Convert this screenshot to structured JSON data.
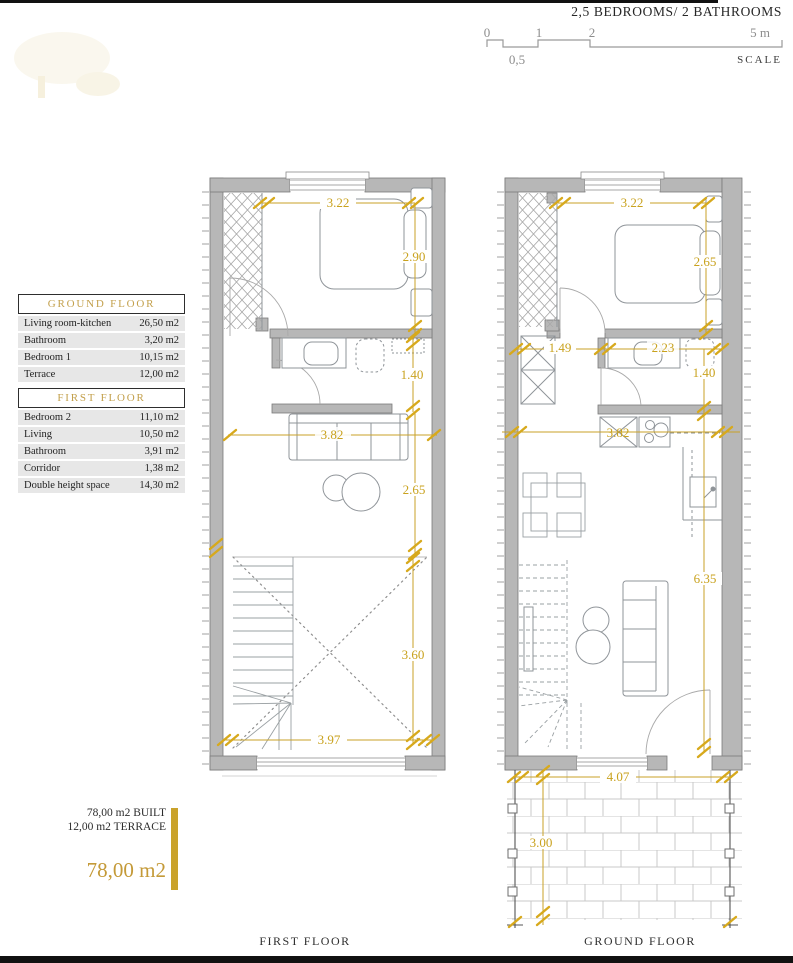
{
  "header": {
    "title": "2,5 BEDROOMS/ 2 BATHROOMS"
  },
  "scale_bar": {
    "t0": "0",
    "t1": "1",
    "t2": "2",
    "t5": "5 m",
    "t05": "0,5",
    "label": "SCALE"
  },
  "tables": {
    "ground": {
      "title": "GROUND FLOOR",
      "rows": [
        {
          "label": "Living room-kitchen",
          "value": "26,50 m2"
        },
        {
          "label": "Bathroom",
          "value": "3,20 m2"
        },
        {
          "label": "Bedroom 1",
          "value": "10,15 m2"
        },
        {
          "label": "Terrace",
          "value": "12,00 m2"
        }
      ]
    },
    "first": {
      "title": "FIRST FLOOR",
      "rows": [
        {
          "label": "Bedroom 2",
          "value": "11,10 m2"
        },
        {
          "label": "Living",
          "value": "10,50 m2"
        },
        {
          "label": "Bathroom",
          "value": "3,91 m2"
        },
        {
          "label": "Corridor",
          "value": "1,38 m2"
        },
        {
          "label": "Double height space",
          "value": "14,30 m2"
        }
      ]
    }
  },
  "summary": {
    "line1": "78,00 m2 BUILT",
    "line2": "12,00 m2 TERRACE",
    "total": "78,00 m2"
  },
  "plans": {
    "ff": {
      "label": "FIRST FLOOR",
      "top_width": "3.22",
      "bedroom_depth": "2.90",
      "bathroom_depth": "1.40",
      "living_width": "3.82",
      "living_depth": "2.65",
      "void_depth": "3.60",
      "bottom_width": "3.97"
    },
    "gf": {
      "label": "GROUND FLOOR",
      "top_width": "3.22",
      "bedroom_depth": "2.65",
      "hall_width": "1.49",
      "bath_width": "2.23",
      "bath_depth": "1.40",
      "kitchen_width": "3.82",
      "living_depth": "6.35",
      "terrace_width": "4.07",
      "terrace_depth": "3.00"
    }
  }
}
